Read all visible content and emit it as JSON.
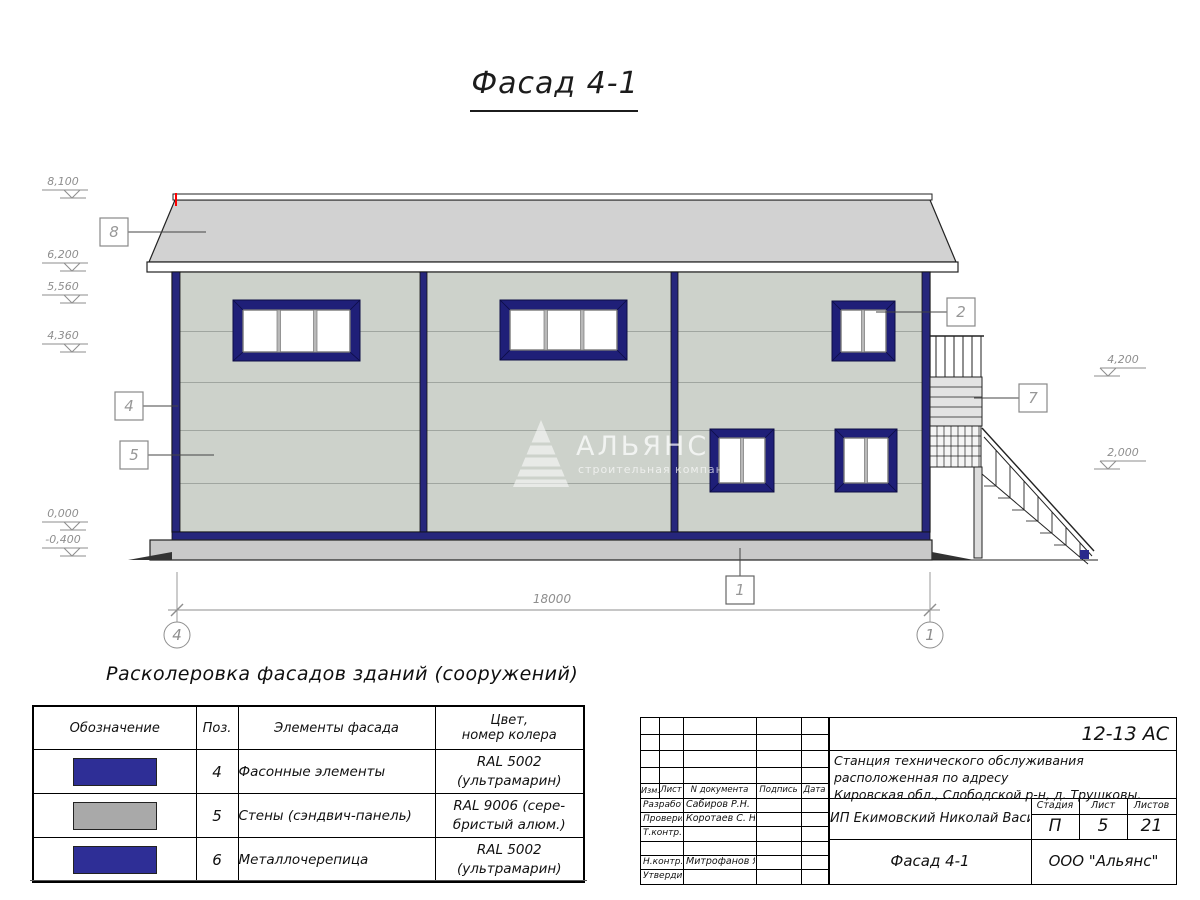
{
  "colors": {
    "ultramarine_trim": "#26267C",
    "window_frame_blue": "#1F1F78",
    "swatch_blue": "#2E2E96",
    "swatch_gray": "#A9A9A9",
    "wall_panel": "#CDD2CB",
    "roof_gray": "#D2D2D2",
    "plinth_gray": "#C9C9C9",
    "linework": "#222222",
    "annotation_gray": "#8E8E8E",
    "red_mark": "#FF0000"
  },
  "title": {
    "text": "Фасад 4-1"
  },
  "drawing": {
    "dimension_total": "18000",
    "axis_left": "4",
    "axis_right": "1",
    "elevations_left": [
      "8,100",
      "6,200",
      "5,560",
      "4,360",
      "0,000",
      "-0,400"
    ],
    "elevations_right": [
      "4,200",
      "2,000"
    ],
    "callouts": [
      "8",
      "4",
      "5",
      "2",
      "7",
      "1"
    ],
    "watermark": {
      "name": "АЛЬЯНС",
      "tagline": "строительная компания"
    }
  },
  "legend": {
    "heading": "Расколеровка фасадов зданий (сооружений)",
    "columns": [
      "Обозначение",
      "Поз.",
      "Элементы фасада",
      "Цвет,\nномер колера"
    ],
    "rows": [
      {
        "pos": "4",
        "element": "Фасонные элементы",
        "color": "RAL 5002\n(ультрамарин)",
        "swatch_style": "background:#2E2E96"
      },
      {
        "pos": "5",
        "element": "Стены (сэндвич-панель)",
        "color": "RAL 9006 (сере-\nбристый алюм.)",
        "swatch_style": "background:#A9A9A9"
      },
      {
        "pos": "6",
        "element": "Металлочерепица",
        "color": "RAL 5002\n(ультрамарин)",
        "swatch_style": "background:#2E2E96"
      }
    ]
  },
  "titleblock": {
    "doc_code": "12-13 АС",
    "address": "Станция технического обслуживания расположенная по адресу\nКировская обл., Слободской р-н, д. Трушковы.",
    "rev_headers": [
      "Изм.",
      "Лист",
      "N документа",
      "Подпись",
      "Дата"
    ],
    "sign_rows": [
      {
        "label": "Разработал",
        "name": "Сабиров Р.Н."
      },
      {
        "label": "Проверил",
        "name": "Коротаев С. Н."
      },
      {
        "label": "Т.контр.",
        "name": ""
      },
      {
        "label": "",
        "name": ""
      },
      {
        "label": "Н.контр.",
        "name": "Митрофанов Я. А."
      },
      {
        "label": "Утвердил",
        "name": ""
      }
    ],
    "client": "ИП Екимовский Николай Васильевич",
    "stage_header": "Стадия",
    "sheet_header": "Лист",
    "sheets_header": "Листов",
    "stage": "П",
    "sheet": "5",
    "sheets": "21",
    "drawing_name": "Фасад 4-1",
    "company": "ООО \"Альянс\""
  }
}
